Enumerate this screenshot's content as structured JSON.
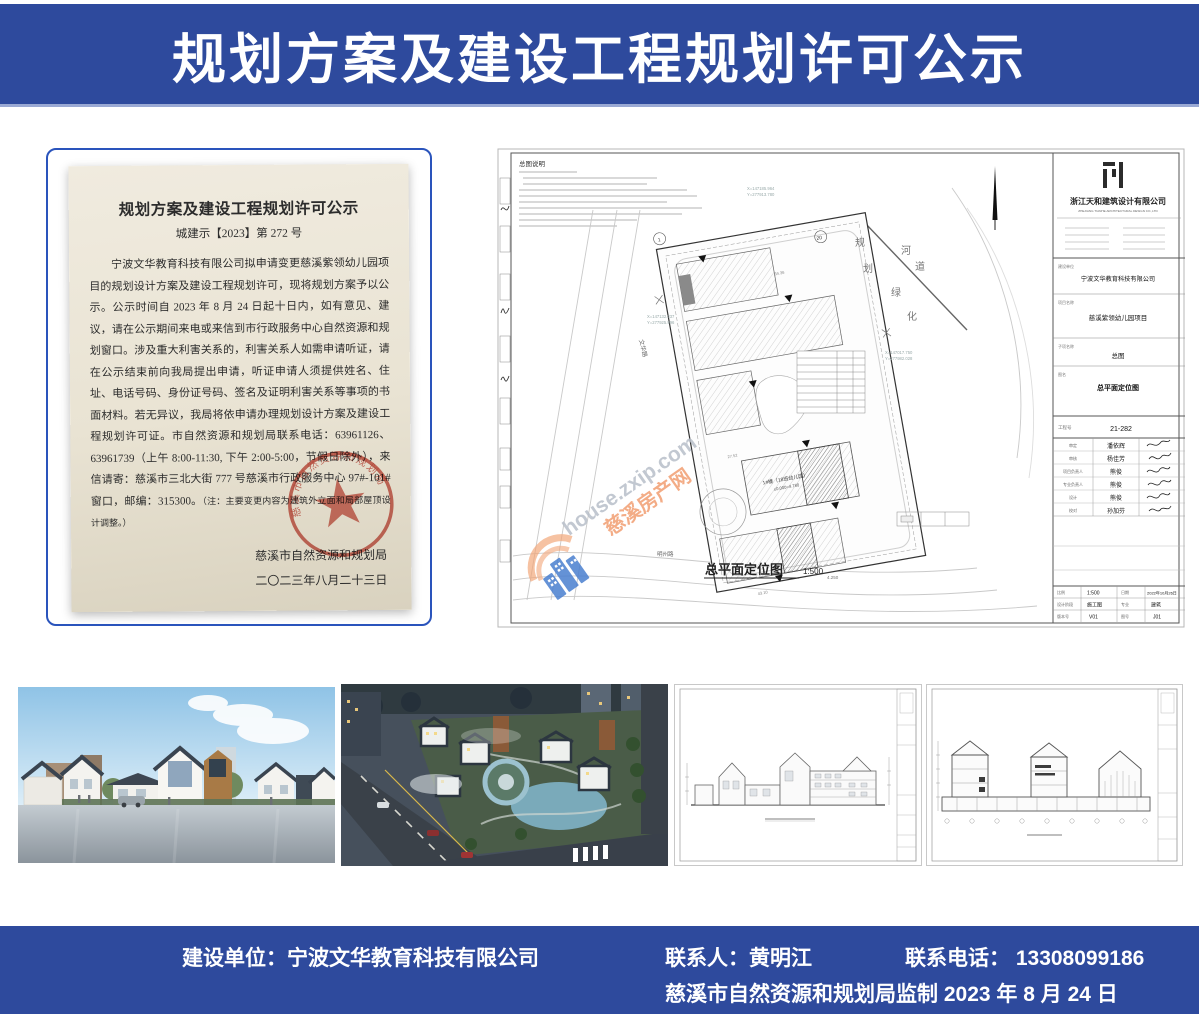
{
  "header": {
    "title": "规划方案及建设工程规划许可公示"
  },
  "notice": {
    "title": "规划方案及建设工程规划许可公示",
    "doc_no": "城建示【2023】第 272 号",
    "body": "宁波文华教育科技有限公司拟申请变更慈溪紫领幼儿园项目的规划设计方案及建设工程规划许可，现将规划方案予以公示。公示时间自 2023 年 8 月 24 日起十日内，如有意见、建议，请在公示期间来电或来信到市行政服务中心自然资源和规划窗口。涉及重大利害关系的，利害关系人如需申请听证，请在公示结束前向我局提出申请，听证申请人须提供姓名、住址、电话号码、身份证号码、签名及证明利害关系等事项的书面材料。若无异议，我局将依申请办理规划设计方案及建设工程规划许可证。市自然资源和规划局联系电话：63961126、63961739（上午 8:00-11:30, 下午 2:00-5:00，节假日除外），来信请寄：慈溪市三北大街 777 号慈溪市行政服务中心 97#-101#窗口，邮编：315300。",
    "note": "（注：主要变更内容为建筑外立面和局部屋顶设计调整。）",
    "agency": "慈溪市自然资源和规划局",
    "date": "二〇二三年八月二十三日",
    "seal_text": "慈溪市自然资源和规划局"
  },
  "siteplan": {
    "notes_title": "总图说明",
    "caption": "总平面定位图",
    "caption_scale": "1:500",
    "level_label": "4.250",
    "road_left": "文华路",
    "road_bottom": "明州路",
    "labels": {
      "gui": "规",
      "hua": "划",
      "he": "河",
      "dao": "道",
      "lv": "绿",
      "hua2": "化"
    },
    "building_label": "1#楼（18班幼儿园）",
    "building_elev": "±0.000=4.780",
    "dims": [
      "34.36",
      "56.36",
      "27.52",
      "43.10"
    ],
    "coords": {
      "c1x": "X=147185.964",
      "c1y": "Y=277913.780",
      "c2x": "X=147132.337",
      "c2y": "Y=277925.996",
      "c3x": "X=147017.750",
      "c3y": "Y=277982.028"
    },
    "watermark": {
      "domain": "house.zxip.com",
      "site": "慈溪房产网"
    },
    "titleblock": {
      "company_cn": "浙江天和建筑设计有限公司",
      "company_en": "ZHEJIANG TIANHE ARCHITECTURAL DESIGN CO.,LTD",
      "client_label": "建设单位",
      "client": "宁波文华教育科技有限公司",
      "project_label": "项目名称",
      "project": "慈溪紫领幼儿园项目",
      "sub_label": "子项名称",
      "sub": "总图",
      "name_label": "图名",
      "name": "总平面定位图",
      "job_label": "工程号",
      "job_no": "21-282",
      "sign_rows": [
        {
          "label": "审定",
          "name": "潘依辉"
        },
        {
          "label": "审核",
          "name": "杨佳芳"
        },
        {
          "label": "项目负责人",
          "name": "熊俊"
        },
        {
          "label": "专业负责人",
          "name": "熊俊"
        },
        {
          "label": "设计",
          "name": "熊俊"
        },
        {
          "label": "校对",
          "name": "孙加芬"
        }
      ],
      "scale_label": "比例",
      "scale": "1:500",
      "date_label": "日期",
      "date": "2022年10月26日",
      "stage_label": "设计阶段",
      "stage": "施工图",
      "major_label": "专业",
      "major": "建筑",
      "ver_label": "版本号",
      "ver": "V01",
      "fig_label": "图号",
      "fig": "J01"
    }
  },
  "footer": {
    "builder": "建设单位：宁波文华教育科技有限公司",
    "contact": "联系人：黄明江",
    "phone": "联系电话： 13308099186",
    "line2": "慈溪市自然资源和规划局监制 2023 年 8 月 24 日"
  },
  "colors": {
    "banner": "#2e4a9d",
    "seal_red": "#c0392b",
    "card_border": "#2a54bc",
    "wm_orange": "#f29e71",
    "wm_blue": "#4a7fd0",
    "wm_gray": "#b8bfc9"
  }
}
